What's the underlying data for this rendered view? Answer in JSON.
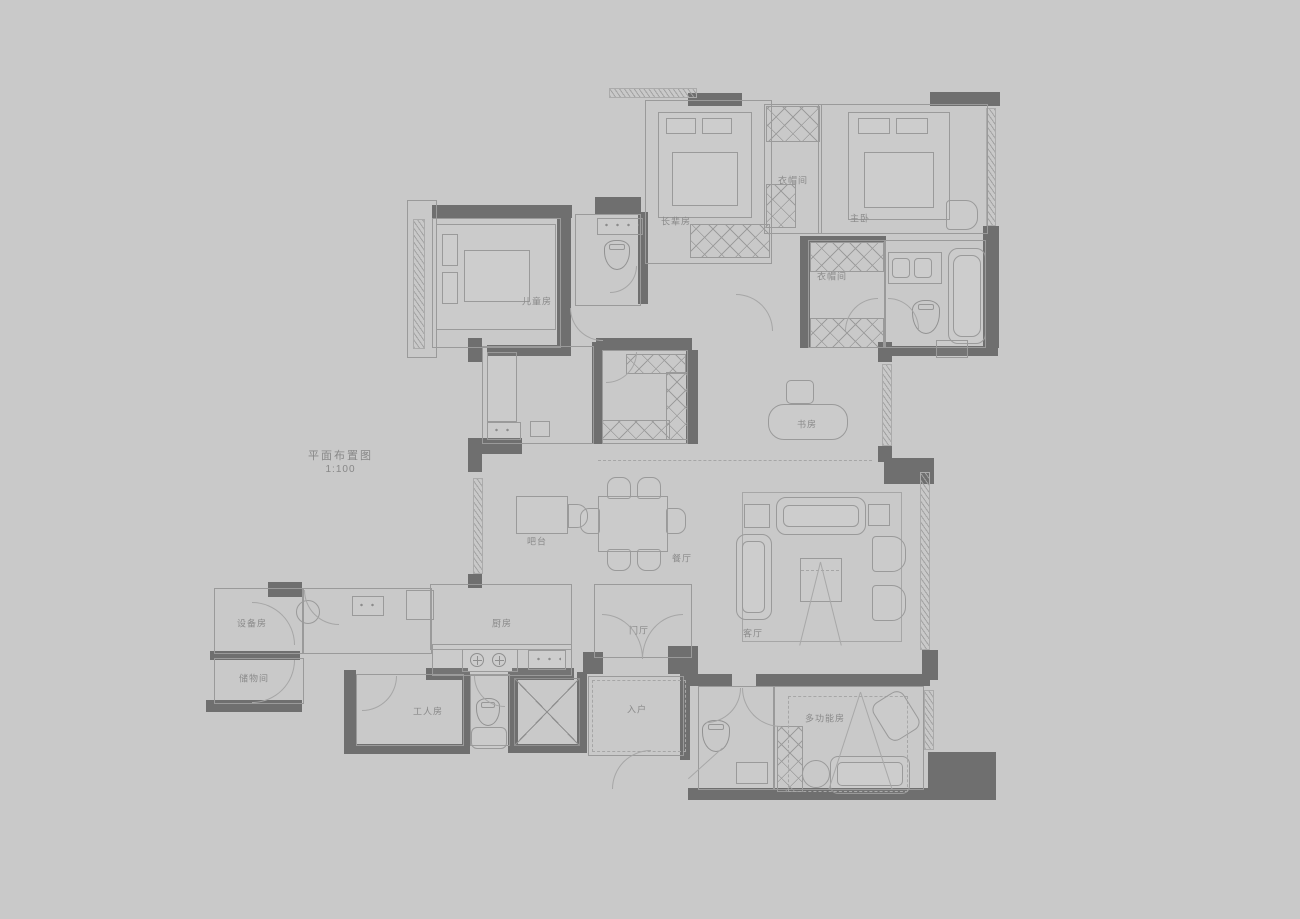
{
  "title": {
    "label": "平面布置图",
    "scale": "1:100"
  },
  "colors": {
    "bg": "#c9c9c9",
    "wall": "#6f6f6f",
    "line": "#9a9a9a",
    "line2": "#a6a6a6",
    "txt": "#8a8a8a"
  },
  "plan_type": "residential-floor-plan",
  "rooms": {
    "elder": {
      "label": "长辈房"
    },
    "cloakroom1": {
      "label": "衣帽间"
    },
    "master": {
      "label": "主卧"
    },
    "cloakroom2": {
      "label": "衣帽间"
    },
    "children": {
      "label": "儿童房"
    },
    "study": {
      "label": "书房"
    },
    "bar": {
      "label": "吧台"
    },
    "dining": {
      "label": "餐厅"
    },
    "living": {
      "label": "客厅"
    },
    "equipment": {
      "label": "设备房"
    },
    "storage": {
      "label": "储物间"
    },
    "kitchen": {
      "label": "厨房"
    },
    "foyer": {
      "label": "门厅"
    },
    "worker": {
      "label": "工人房"
    },
    "entry": {
      "label": "入户"
    },
    "multifunction": {
      "label": "多功能房"
    }
  }
}
